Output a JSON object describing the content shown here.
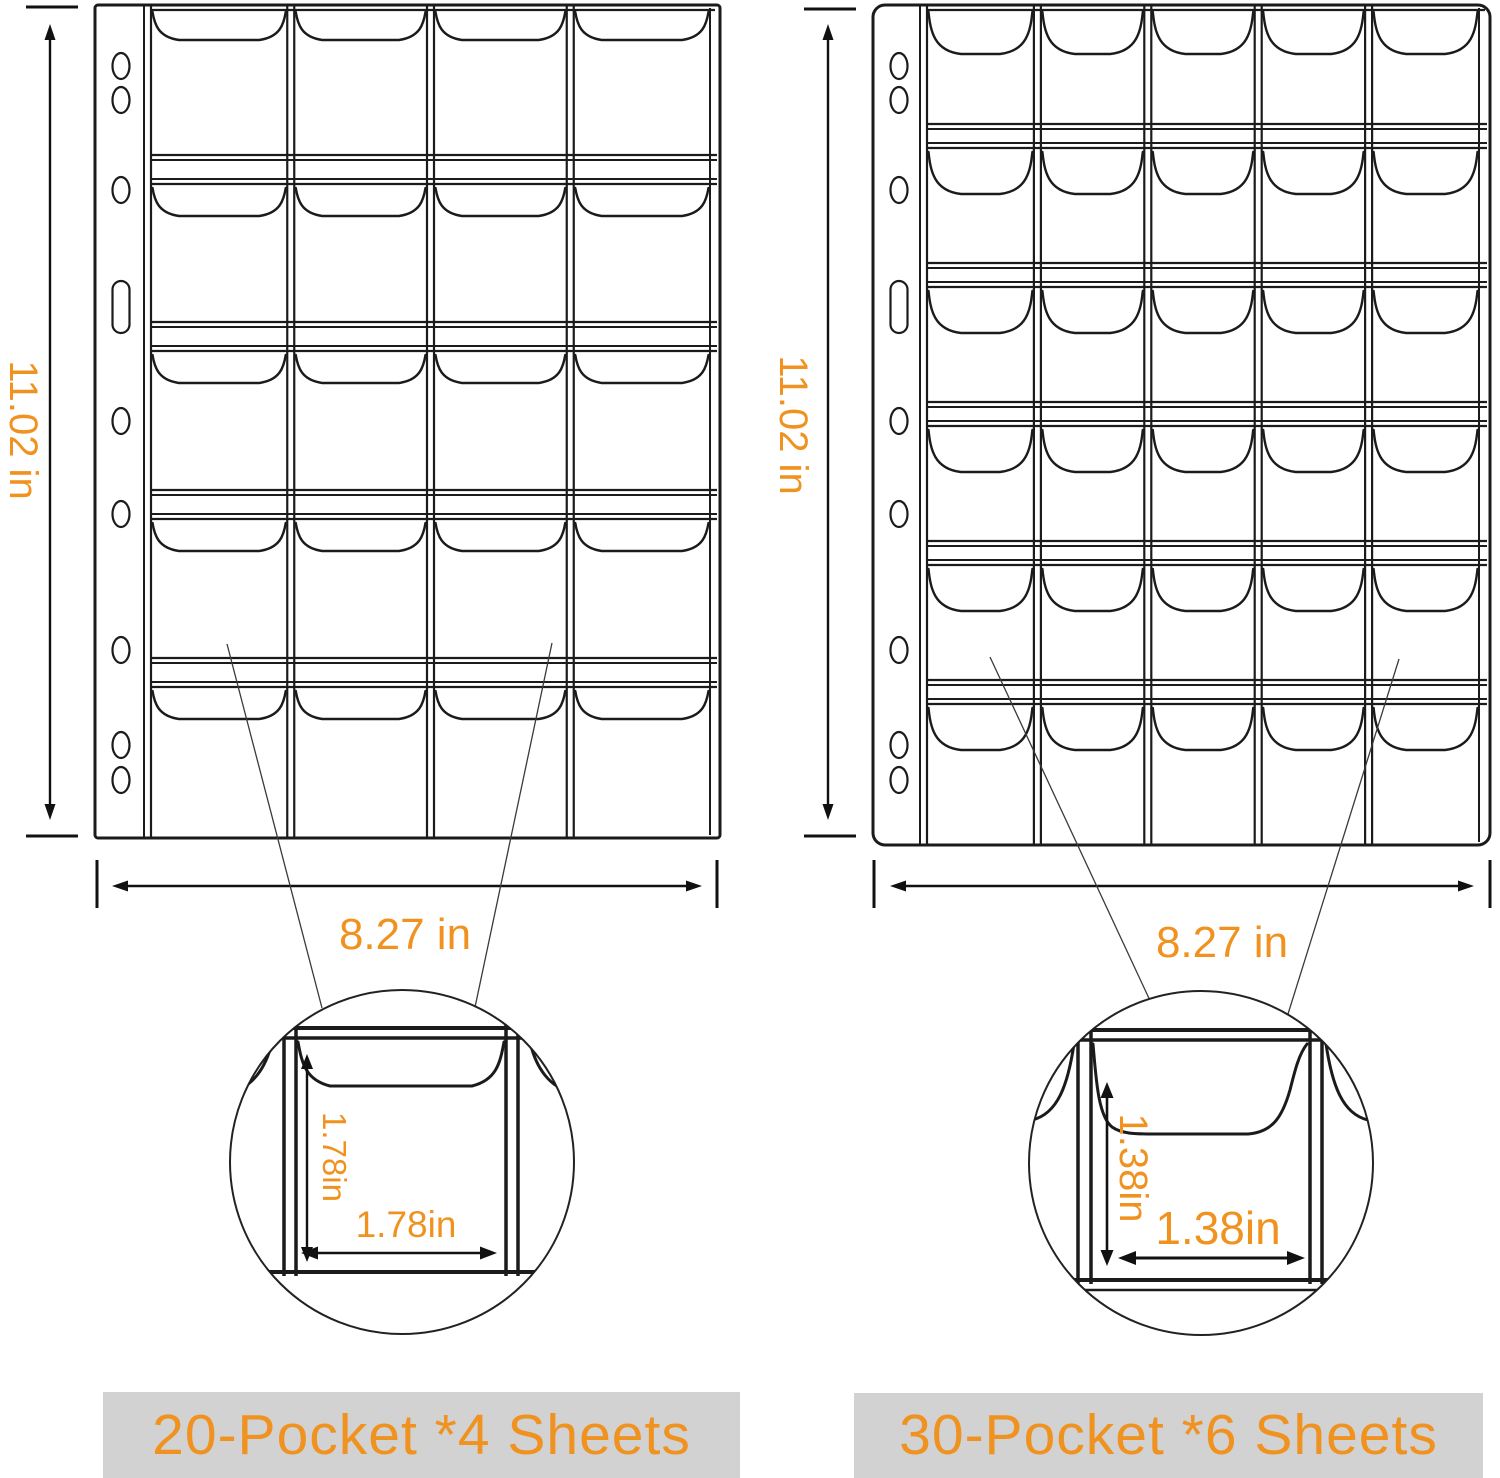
{
  "meta": {
    "description": "Coin collection pocket pages size diagram"
  },
  "palette": {
    "accent_orange": "#F0921F",
    "line_black": "#1B1B1B",
    "caption_bg": "#D2D2D2",
    "paper_white": "#FFFFFF"
  },
  "sheets": [
    {
      "name": "20-pocket sheet",
      "pockets": 20,
      "columns": 4,
      "rows": 5,
      "height_label": "11.02 in",
      "width_label": "8.27 in",
      "pocket_height_label": "1.78in",
      "pocket_width_label": "1.78in",
      "caption": "20-Pocket *4 Sheets"
    },
    {
      "name": "30-pocket sheet",
      "pockets": 30,
      "columns": 5,
      "rows": 6,
      "height_label": "11.02 in",
      "width_label": "8.27 in",
      "pocket_height_label": "1.38in",
      "pocket_width_label": "1.38in",
      "caption": "30-Pocket *6 Sheets"
    }
  ]
}
